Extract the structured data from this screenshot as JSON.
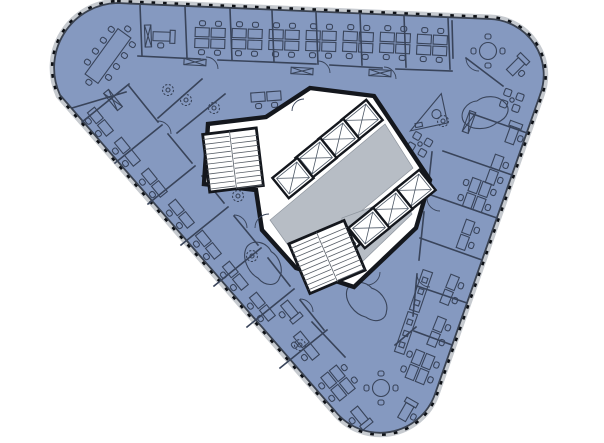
{
  "colors": {
    "floor": "#8599c0",
    "outline": "#3a4250",
    "facade": "#c6cacf",
    "tick": "#0d1015",
    "wall": "#14171d",
    "lobby": "#b7bdc5",
    "furn": "#39445a",
    "ink2": "#4a5563"
  },
  "plan": {
    "shell_d": "M117,3 L490,19 A56,56 0 0 1 540,95 L435,394 A58,58 0 0 1 335,411 L60,95 A65,65 0 0 1 117,3 Z",
    "core_d": "M310,88 L374,96 L430,180 L416,228 L354,287 L296,268 L262,230 L256,190 L204,184 L208,124 L266,117 Z",
    "lobby_d": "M385,124 L413,168 L300,262 L270,220 Z",
    "lobby2_d": "M342,218 L402,196 L412,214 L362,262 L338,242 Z",
    "partitions": [
      [
        140,
        5,
        142,
        56
      ],
      [
        185,
        7,
        187,
        58
      ],
      [
        230,
        9,
        232,
        60
      ],
      [
        272,
        11,
        274,
        62
      ],
      [
        316,
        13,
        318,
        64
      ],
      [
        360,
        14,
        362,
        65
      ],
      [
        404,
        16,
        406,
        67
      ],
      [
        448,
        18,
        450,
        69
      ],
      [
        138,
        56,
        200,
        59
      ],
      [
        218,
        60,
        316,
        64
      ],
      [
        330,
        65,
        382,
        68
      ],
      [
        396,
        69,
        452,
        71
      ],
      [
        72,
        108,
        126,
        92
      ],
      [
        466,
        58,
        503,
        86
      ],
      [
        452,
        21,
        453,
        58
      ],
      [
        82,
        122,
        129,
        84
      ],
      [
        115,
        163,
        162,
        125
      ],
      [
        148,
        204,
        195,
        166
      ],
      [
        181,
        245,
        228,
        207
      ],
      [
        214,
        286,
        261,
        248
      ],
      [
        247,
        327,
        294,
        289
      ],
      [
        280,
        368,
        327,
        330
      ],
      [
        129,
        86,
        158,
        122
      ],
      [
        168,
        134,
        192,
        163
      ],
      [
        202,
        176,
        224,
        203
      ],
      [
        234,
        216,
        258,
        245
      ],
      [
        268,
        258,
        290,
        286
      ],
      [
        300,
        300,
        324,
        330
      ],
      [
        527,
        133,
        470,
        113
      ],
      [
        512,
        175,
        443,
        151
      ],
      [
        497,
        218,
        428,
        194
      ],
      [
        482,
        260,
        420,
        238
      ],
      [
        467,
        303,
        417,
        286
      ],
      [
        452,
        345,
        414,
        331
      ],
      [
        432,
        152,
        427,
        198
      ],
      [
        424,
        212,
        419,
        260
      ],
      [
        417,
        274,
        413,
        316
      ],
      [
        158,
        118,
        202,
        79
      ],
      [
        177,
        133,
        225,
        94
      ],
      [
        312,
        322,
        345,
        357
      ],
      [
        395,
        345,
        416,
        327
      ]
    ],
    "door_arcs": [
      "M206,57 a12,12 0 0 1 12,12",
      "M318,61 a12,12 0 0 1 12,12",
      "M384,67 a12,12 0 0 1 12,12",
      "M158,121 a13,13 0 0 1 13,13",
      "M234,215 a13,13 0 0 1 13,13",
      "M300,299 a13,13 0 0 1 13,13",
      "M427,198 a13,13 0 0 0 13,13",
      "M417,274 a13,13 0 0 0 13,13",
      "M269,214 a14,14 0 0 0 -14,14",
      "M380,272 a13,13 0 0 1 -13,13",
      "M304,99 a12,12 0 0 0 -12,12",
      "M466,58 a13,13 0 0 0 13,13"
    ],
    "elevators": [
      {
        "x": 362,
        "y": 120,
        "r": -39,
        "w": 32,
        "h": 26
      },
      {
        "x": 339,
        "y": 139,
        "r": -39,
        "w": 32,
        "h": 26
      },
      {
        "x": 316,
        "y": 158,
        "r": -39,
        "w": 32,
        "h": 26
      },
      {
        "x": 293,
        "y": 178,
        "r": -39,
        "w": 32,
        "h": 26
      },
      {
        "x": 415,
        "y": 190,
        "r": -39,
        "w": 32,
        "h": 26
      },
      {
        "x": 392,
        "y": 209,
        "r": -39,
        "w": 32,
        "h": 26
      },
      {
        "x": 369,
        "y": 228,
        "r": -39,
        "w": 32,
        "h": 26
      },
      {
        "x": 346,
        "y": 244,
        "r": -39,
        "w": 22,
        "h": 18
      }
    ],
    "stairs": [
      {
        "x": 233,
        "y": 160,
        "r": -7,
        "w": 54,
        "h": 58
      },
      {
        "x": 327,
        "y": 257,
        "r": -23,
        "w": 60,
        "h": 54
      }
    ],
    "furniture": [
      [
        "conf",
        108,
        56,
        36
      ],
      [
        "desk1",
        163,
        37,
        2
      ],
      [
        "desk1",
        517,
        66,
        -45
      ],
      [
        "desk1",
        513,
        134,
        -70
      ],
      [
        "desk1",
        360,
        417,
        51
      ],
      [
        "desk1",
        407,
        411,
        -60
      ],
      [
        "desk1",
        290,
        311,
        51
      ],
      [
        "pod4",
        210,
        38,
        2
      ],
      [
        "pod4",
        247,
        39,
        2
      ],
      [
        "pod4",
        284,
        40,
        2
      ],
      [
        "pod4",
        321,
        41,
        2
      ],
      [
        "pod4",
        358,
        42,
        3
      ],
      [
        "pod4",
        395,
        43,
        3
      ],
      [
        "pod4",
        432,
        45,
        3
      ],
      [
        "pod4",
        338,
        383,
        51
      ],
      [
        "pod4",
        420,
        367,
        -68
      ],
      [
        "pod4",
        477,
        195,
        -70
      ],
      [
        "pod2",
        266,
        97,
        -4
      ],
      [
        "pod2",
        100,
        122,
        51
      ],
      [
        "pod2",
        127,
        152,
        51
      ],
      [
        "pod2",
        154,
        183,
        51
      ],
      [
        "pod2",
        181,
        214,
        51
      ],
      [
        "pod2",
        208,
        245,
        51
      ],
      [
        "pod2",
        235,
        276,
        51
      ],
      [
        "pod2",
        262,
        307,
        51
      ],
      [
        "pod2",
        306,
        346,
        51
      ],
      [
        "pod2",
        495,
        170,
        -70
      ],
      [
        "pod2",
        466,
        235,
        -70
      ],
      [
        "pod2",
        450,
        290,
        -68
      ],
      [
        "pod2",
        437,
        332,
        -68
      ],
      [
        "round4",
        488,
        51,
        0
      ],
      [
        "round4",
        381,
        388,
        0
      ],
      [
        "lounge4",
        512,
        100,
        20
      ],
      [
        "lounge4",
        420,
        144,
        30
      ],
      [
        "bench",
        421,
        291,
        19
      ],
      [
        "bench",
        406,
        333,
        19
      ],
      [
        "recep",
        427,
        113,
        -12
      ],
      [
        "plant",
        186,
        100,
        0
      ],
      [
        "plant",
        214,
        108,
        0
      ],
      [
        "plant",
        168,
        90,
        0
      ],
      [
        "plant",
        238,
        196,
        0
      ],
      [
        "plant",
        252,
        256,
        0
      ],
      [
        "plant",
        443,
        121,
        0
      ],
      [
        "plant",
        300,
        345,
        0
      ],
      [
        "blob",
        264,
        264,
        55
      ],
      [
        "blob",
        486,
        112,
        -15
      ],
      [
        "blob",
        368,
        302,
        40
      ],
      [
        "xbrace",
        195,
        62,
        3
      ],
      [
        "xbrace",
        302,
        71,
        3
      ],
      [
        "xbrace",
        380,
        73,
        3
      ],
      [
        "xbrace",
        113,
        100,
        51
      ],
      [
        "xbrace",
        469,
        122,
        -70
      ],
      [
        "xbrace",
        148,
        36,
        88
      ]
    ]
  }
}
